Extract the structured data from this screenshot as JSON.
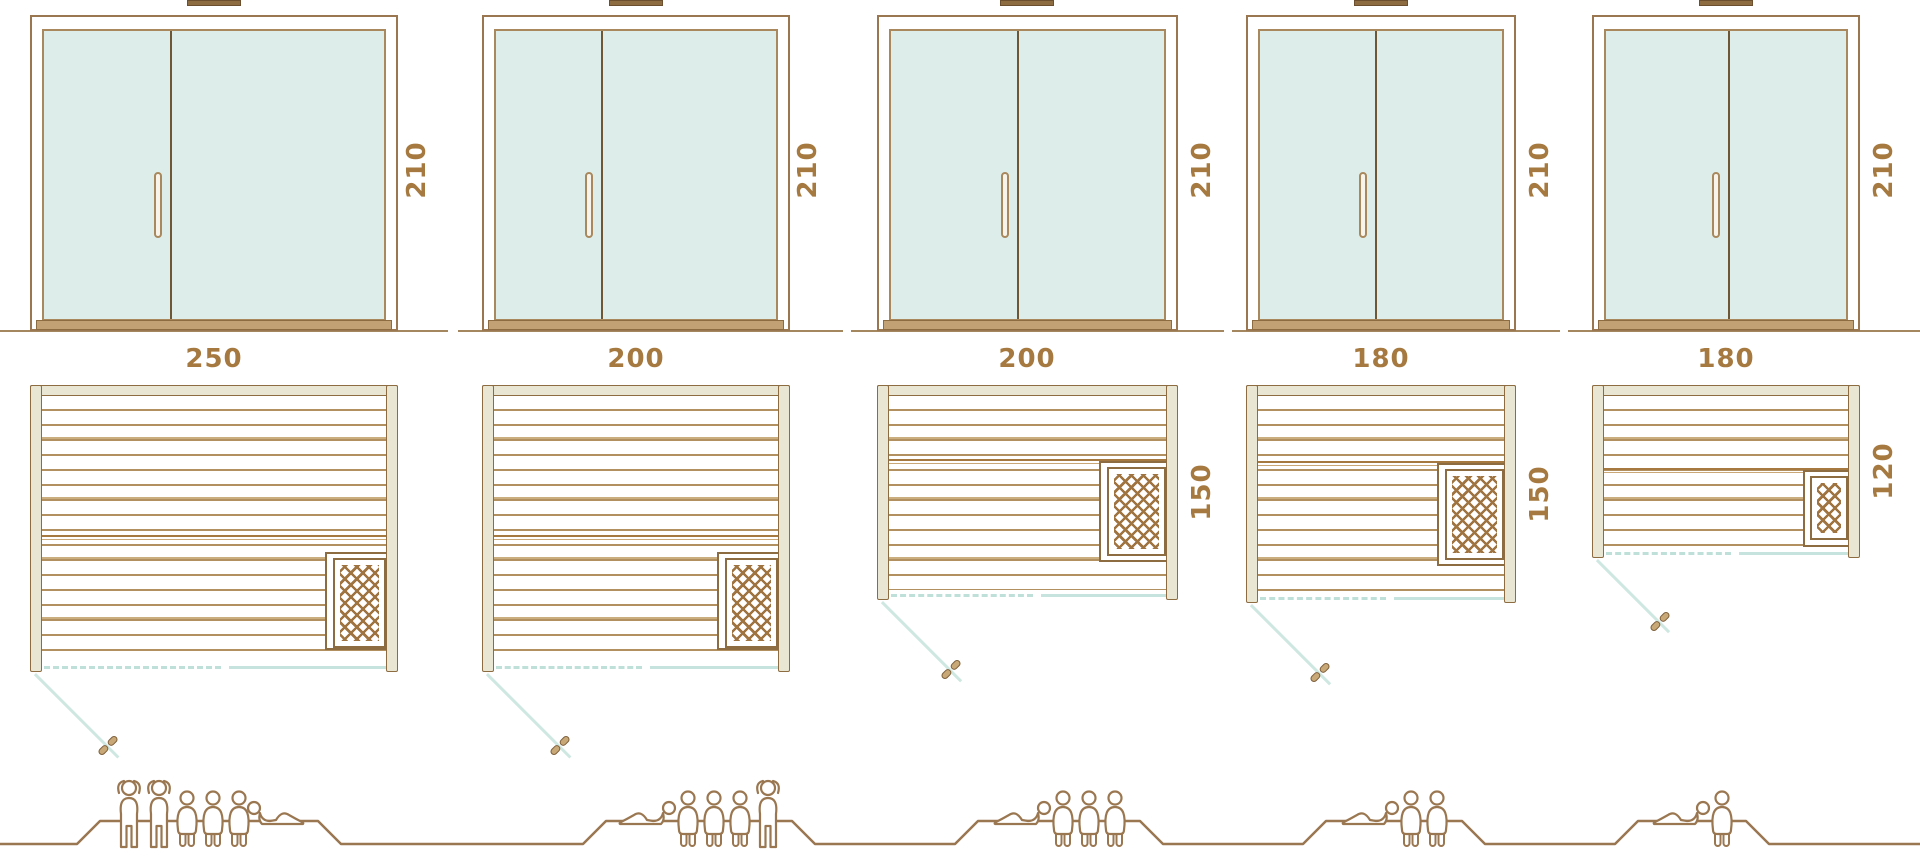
{
  "colors": {
    "line_brown": "#9a7750",
    "wall_tan": "#eae6d4",
    "glass_mint": "#ddedea",
    "swing_teal": "#c6e3dd",
    "dimension_text": "#a5793f",
    "plank_brown": "#b3905f"
  },
  "icons": {
    "heater": "heater-crosshatch-icon",
    "door_swing": "door-swing-line",
    "door_leaf": "door-leaf-symbol",
    "person_standing": "person-standing-icon",
    "person_sitting": "person-sitting-icon",
    "person_lying": "person-lying-icon"
  },
  "columns": [
    {
      "width_label": "250",
      "height_label": "210",
      "depth_label": "200",
      "people": [
        "standing",
        "standing",
        "sitting",
        "sitting",
        "sitting",
        "lying"
      ]
    },
    {
      "width_label": "200",
      "height_label": "210",
      "depth_label": "200",
      "people": [
        "lying",
        "sitting",
        "sitting",
        "sitting",
        "standing"
      ]
    },
    {
      "width_label": "200",
      "height_label": "210",
      "depth_label": "150",
      "people": [
        "lying",
        "sitting",
        "sitting",
        "sitting"
      ]
    },
    {
      "width_label": "180",
      "height_label": "210",
      "depth_label": "150",
      "people": [
        "lying",
        "sitting",
        "sitting"
      ]
    },
    {
      "width_label": "180",
      "height_label": "210",
      "depth_label": "120",
      "people": [
        "lying",
        "sitting"
      ]
    }
  ]
}
